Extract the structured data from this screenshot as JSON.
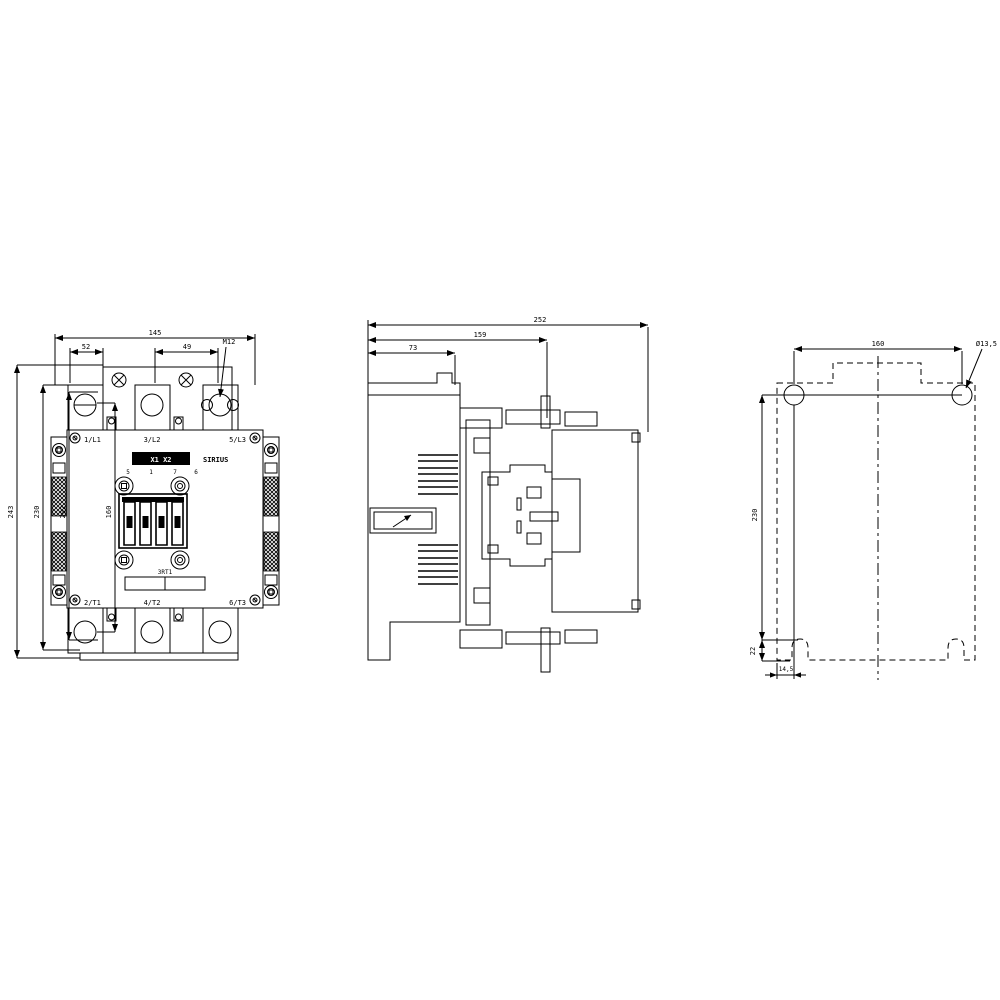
{
  "front": {
    "dim_width": "145",
    "dim_left": "52",
    "dim_right": "49",
    "leader": "M12",
    "vdim_outer": "243",
    "vdim_2": "230",
    "vdim_3": "202",
    "vdim_inner": "160",
    "t1": "1/L1",
    "t2": "3/L2",
    "t3": "5/L3",
    "t4": "2/T1",
    "t5": "4/T2",
    "t6": "6/T3",
    "strip": "X1 X2",
    "brand": "SIRIUS",
    "type": "3RT1",
    "p1": "5",
    "p2": "1",
    "p3": "7",
    "p4": "6"
  },
  "side": {
    "dim_depth": "252",
    "dim_mid": "159",
    "dim_front": "73"
  },
  "plan": {
    "dim_spacing": "160",
    "leader": "Ø13,5",
    "dim_height": "230",
    "dim_offset": "22",
    "dim_slot": "14,5"
  }
}
